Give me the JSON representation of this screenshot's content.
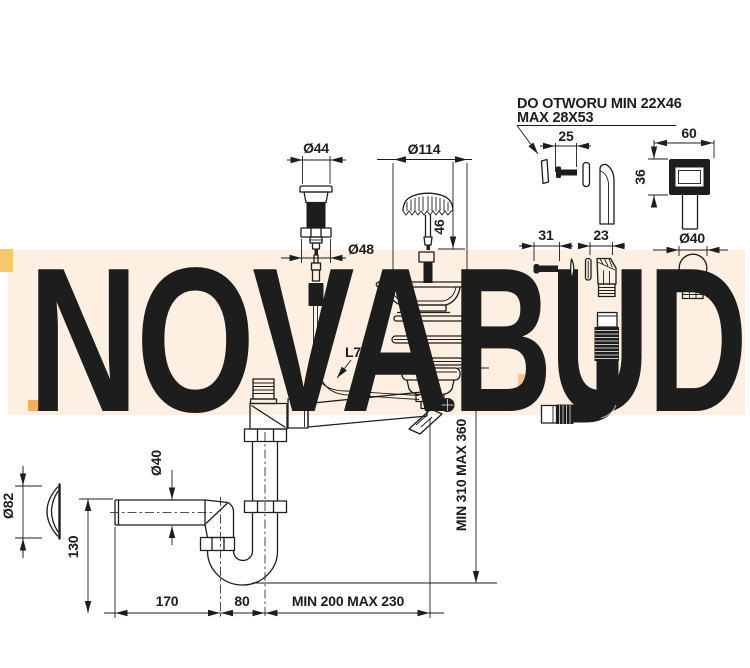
{
  "drawing": {
    "note": {
      "line1": "DO OTWORU MIN 22X46",
      "line2": "MAX 28X53"
    },
    "dims": {
      "plug": "Ø44",
      "plug_nut": "Ø48",
      "strainer": "Ø114",
      "screw_len": "46",
      "ovf_screw": "25",
      "cover_w": "60",
      "cover_h": "36",
      "screw2": "31",
      "elbow_w": "23",
      "ball": "Ø40",
      "cable": "L700",
      "height": "MIN 310 MAX 360",
      "rosette": "Ø82",
      "outlet_pipe": "Ø40",
      "outlet_h": "130",
      "seg1": "170",
      "seg2": "80",
      "seg3": "MIN 200 MAX 230"
    }
  },
  "watermark": {
    "left": "NOVA",
    "right": "BUD"
  },
  "colors": {
    "line": "#1d1d1d",
    "band": "#fdf0e2",
    "nova": "#e4e6e9",
    "bud": "#f8dcc2",
    "accent": "#f6c48c"
  }
}
